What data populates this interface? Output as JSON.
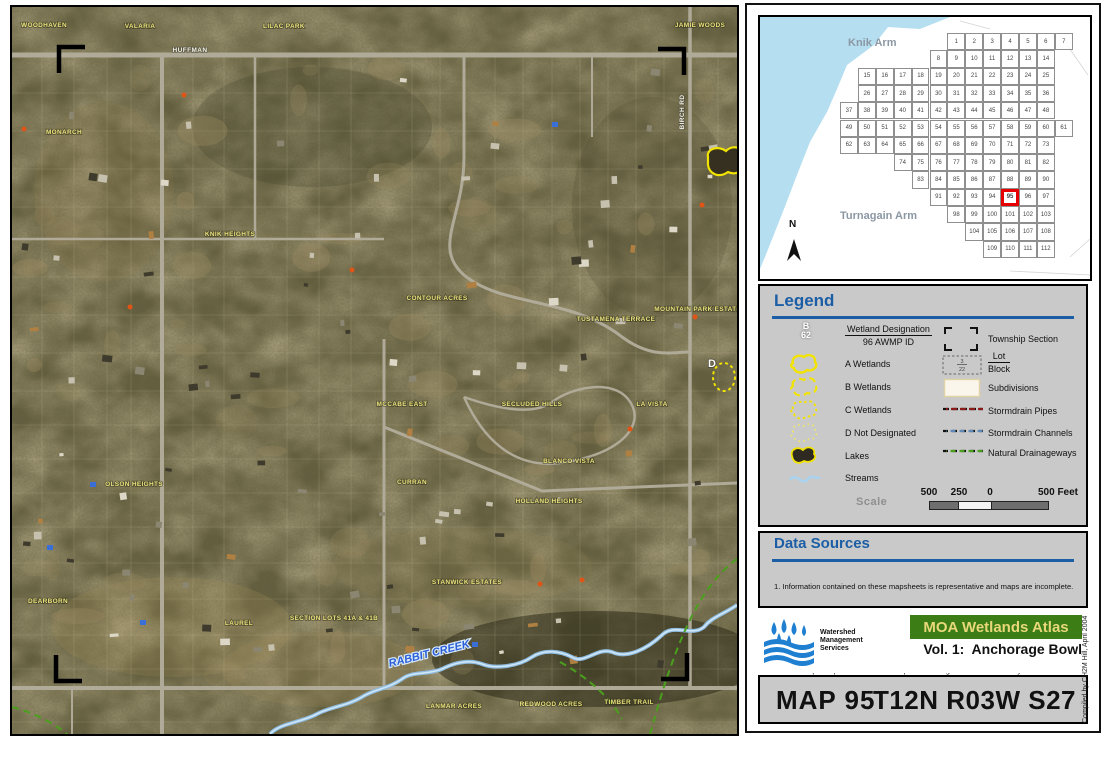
{
  "colors": {
    "accent_blue": "#1b5ea6",
    "wetland_yellow": "#f2e400",
    "water_blue": "#b5dff0",
    "highlight_red": "#e60000",
    "atlas_green": "#3c7d16",
    "atlas_text": "#e8d87a"
  },
  "index_map": {
    "knik": "Knik Arm",
    "turnagain": "Turnagain Arm",
    "north": "N",
    "highlight": 95,
    "rows": [
      {
        "start": 6,
        "from": 1,
        "to": 7
      },
      {
        "start": 5,
        "from": 8,
        "to": 14
      },
      {
        "start": 1,
        "from": 15,
        "to": 25
      },
      {
        "start": 1,
        "from": 26,
        "to": 36
      },
      {
        "start": 0,
        "from": 37,
        "to": 48
      },
      {
        "start": 0,
        "from": 49,
        "to": 61
      },
      {
        "start": 0,
        "from": 62,
        "to": 73
      },
      {
        "start": 3,
        "from": 74,
        "to": 82
      },
      {
        "start": 4,
        "from": 83,
        "to": 90
      },
      {
        "start": 5,
        "from": 91,
        "to": 97
      },
      {
        "start": 6,
        "from": 98,
        "to": 103
      },
      {
        "start": 7,
        "from": 104,
        "to": 108
      },
      {
        "start": 8,
        "from": 109,
        "to": 112
      }
    ]
  },
  "legend": {
    "title": "Legend",
    "sample_letter": "B",
    "sample_number": "62",
    "designation_top": "Wetland Designation",
    "designation_bottom": "96 AWMP ID",
    "a": "A Wetlands",
    "b": "B Wetlands",
    "c": "C Wetlands",
    "d": "D Not Designated",
    "lakes": "Lakes",
    "streams": "Streams",
    "township": "Township Section",
    "lot_top": "Lot",
    "lot_bottom": "Block",
    "lot_sample_top": "3",
    "lot_sample_bottom": "22",
    "subdivisions": "Subdivisions",
    "pipes": "Stormdrain Pipes",
    "channels": "Stormdrain Channels",
    "drainageways": "Natural Drainageways",
    "scale_label": "Scale",
    "tick1": "500",
    "tick2": "250",
    "tick3": "0",
    "tick4": "500 Feet"
  },
  "data_sources": {
    "title": "Data Sources",
    "notes": [
      "1. Information contained on these mapsheets is representative and maps are incomplete.",
      "    Confirm wetland delineations for site specific applications.",
      "2. Wetlands data source: MOA Planning Department.",
      "3. Base map and parcel information is provided for general reference only.",
      "4. Base Imagery: 2001 IKONOS satellite imagery."
    ]
  },
  "branding": {
    "org": [
      "Watershed",
      "Management",
      "Services"
    ],
    "atlas_title": "MOA Wetlands Atlas",
    "volume": "Vol. 1:  Anchorage Bowl",
    "map_number": "MAP 95",
    "township": "T12N R03W S27",
    "credit": "Compiled by CH2M Hill, April 2004"
  },
  "map": {
    "labels": [
      {
        "t": "WOODHAVEN",
        "x": 32,
        "y": 20,
        "k": "sub"
      },
      {
        "t": "VALARIA",
        "x": 128,
        "y": 21,
        "k": "sub"
      },
      {
        "t": "LILAC PARK",
        "x": 272,
        "y": 21,
        "k": "sub"
      },
      {
        "t": "JAMIE WOODS",
        "x": 688,
        "y": 20,
        "k": "sub"
      },
      {
        "t": "MONARCH",
        "x": 52,
        "y": 127,
        "k": "sub"
      },
      {
        "t": "KNIK HEIGHTS",
        "x": 218,
        "y": 229,
        "k": "sub"
      },
      {
        "t": "CONTOUR ACRES",
        "x": 425,
        "y": 293,
        "k": "sub"
      },
      {
        "t": "TUSTAMENA TERRACE",
        "x": 604,
        "y": 314,
        "k": "sub"
      },
      {
        "t": "MOUNTAIN PARK ESTATES",
        "x": 688,
        "y": 304,
        "k": "sub"
      },
      {
        "t": "MCCABE EAST",
        "x": 390,
        "y": 399,
        "k": "sub"
      },
      {
        "t": "SECLUDED HILLS",
        "x": 520,
        "y": 399,
        "k": "sub"
      },
      {
        "t": "LA VISTA",
        "x": 640,
        "y": 399,
        "k": "sub"
      },
      {
        "t": "BLANCO VISTA",
        "x": 557,
        "y": 456,
        "k": "sub"
      },
      {
        "t": "CURRAN",
        "x": 400,
        "y": 477,
        "k": "sub"
      },
      {
        "t": "OLSON HEIGHTS",
        "x": 122,
        "y": 479,
        "k": "sub"
      },
      {
        "t": "HOLLAND HEIGHTS",
        "x": 537,
        "y": 496,
        "k": "sub"
      },
      {
        "t": "DEARBORN",
        "x": 36,
        "y": 596,
        "k": "sub"
      },
      {
        "t": "LAUREL",
        "x": 227,
        "y": 618,
        "k": "sub"
      },
      {
        "t": "SECTION LOTS 41A & 41B",
        "x": 322,
        "y": 613,
        "k": "sub"
      },
      {
        "t": "STANWICK ESTATES",
        "x": 455,
        "y": 577,
        "k": "sub"
      },
      {
        "t": "LANMAR ACRES",
        "x": 442,
        "y": 701,
        "k": "sub"
      },
      {
        "t": "REDWOOD ACRES",
        "x": 539,
        "y": 699,
        "k": "sub"
      },
      {
        "t": "TIMBER TRAIL",
        "x": 617,
        "y": 697,
        "k": "sub"
      },
      {
        "t": "HUFFMAN",
        "x": 178,
        "y": 45,
        "k": "street"
      },
      {
        "t": "BIRCH RD",
        "x": 672,
        "y": 105,
        "k": "street",
        "rot": -90
      },
      {
        "t": "RABBIT CREEK",
        "x": 418,
        "y": 650,
        "k": "creek",
        "rot": -14
      },
      {
        "t": "D",
        "x": 700,
        "y": 360,
        "k": "wet"
      }
    ]
  }
}
